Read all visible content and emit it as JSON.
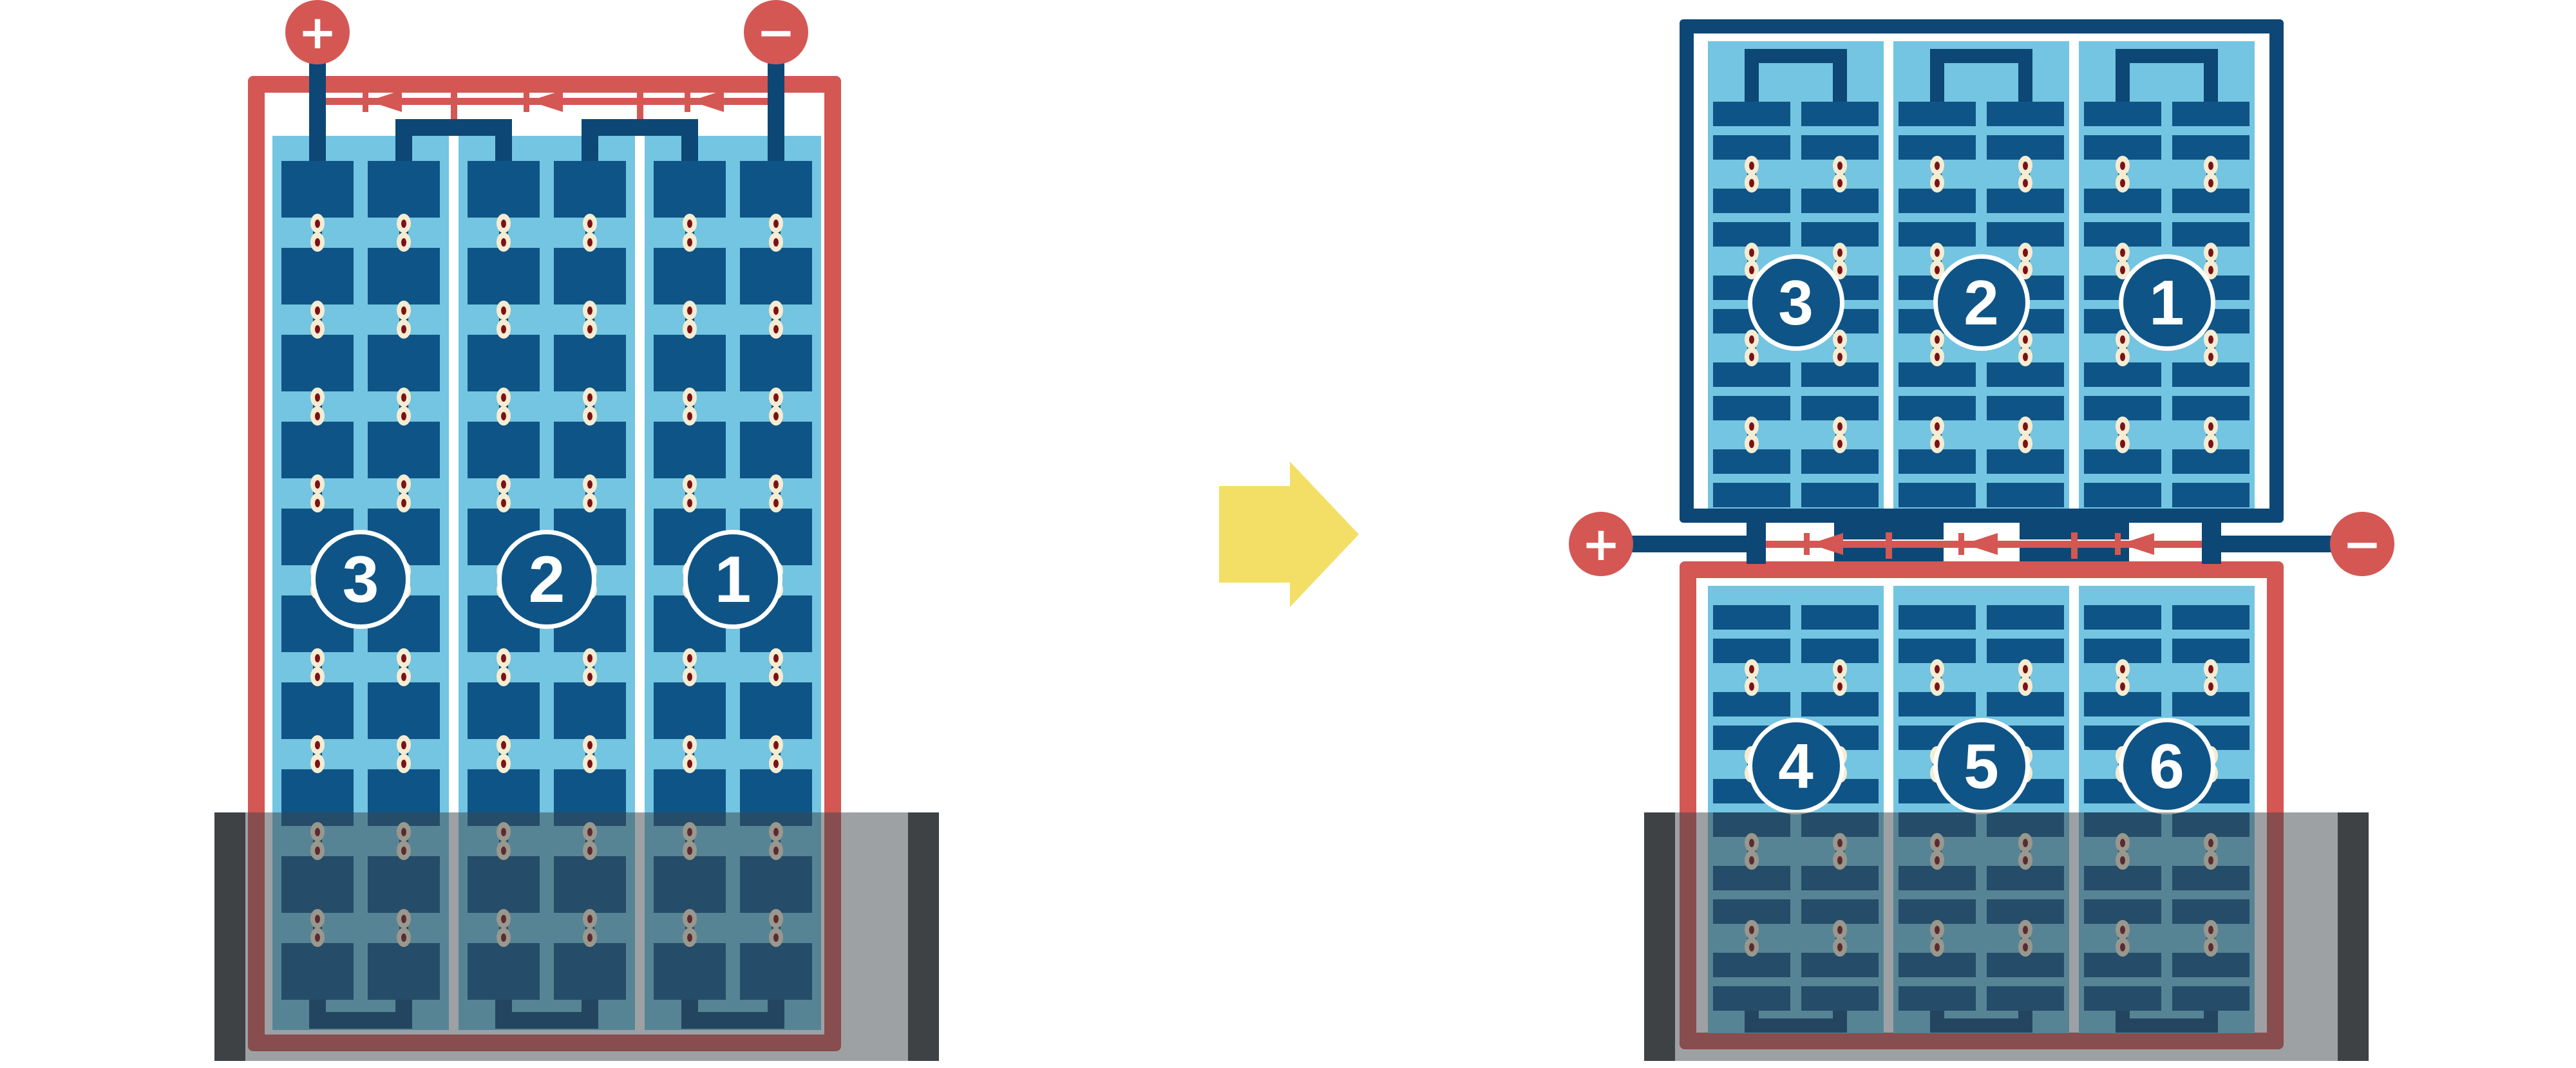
{
  "left_module": {
    "terminals": {
      "positive_label": "+",
      "negative_label": "−"
    },
    "bypass_diode_count": 3,
    "strings": [
      {
        "label": "3"
      },
      {
        "label": "2"
      },
      {
        "label": "1"
      }
    ],
    "cell_rows": 10,
    "cell_columns_per_string": 2,
    "shaded_region": true
  },
  "right_module": {
    "terminals": {
      "positive_label": "+",
      "negative_label": "−"
    },
    "bypass_diode_count": 3,
    "top_half": {
      "strings": [
        {
          "label": "3"
        },
        {
          "label": "2"
        },
        {
          "label": "1"
        }
      ],
      "cell_rows": 10,
      "cell_columns_per_string": 2,
      "shaded_region": false
    },
    "bottom_half": {
      "strings": [
        {
          "label": "4"
        },
        {
          "label": "5"
        },
        {
          "label": "6"
        }
      ],
      "cell_rows": 10,
      "cell_columns_per_string": 2,
      "shaded_region": true
    }
  },
  "arrow": {
    "direction": "right"
  },
  "colors": {
    "red": "#d45753",
    "navy": "#0d4776",
    "cell_blue": "#0f5486",
    "panel_blue": "#73c5e1",
    "dot_ring": "#f6ecd2",
    "dot_center": "#7c1216",
    "arrow_yellow": "#f3df66",
    "shade_overlay": "rgba(60,68,74,0.5)",
    "shade_edge": "#3e4245",
    "badge_text": "#ffffff",
    "terminal_text": "#ffffff",
    "background": "#ffffff"
  }
}
